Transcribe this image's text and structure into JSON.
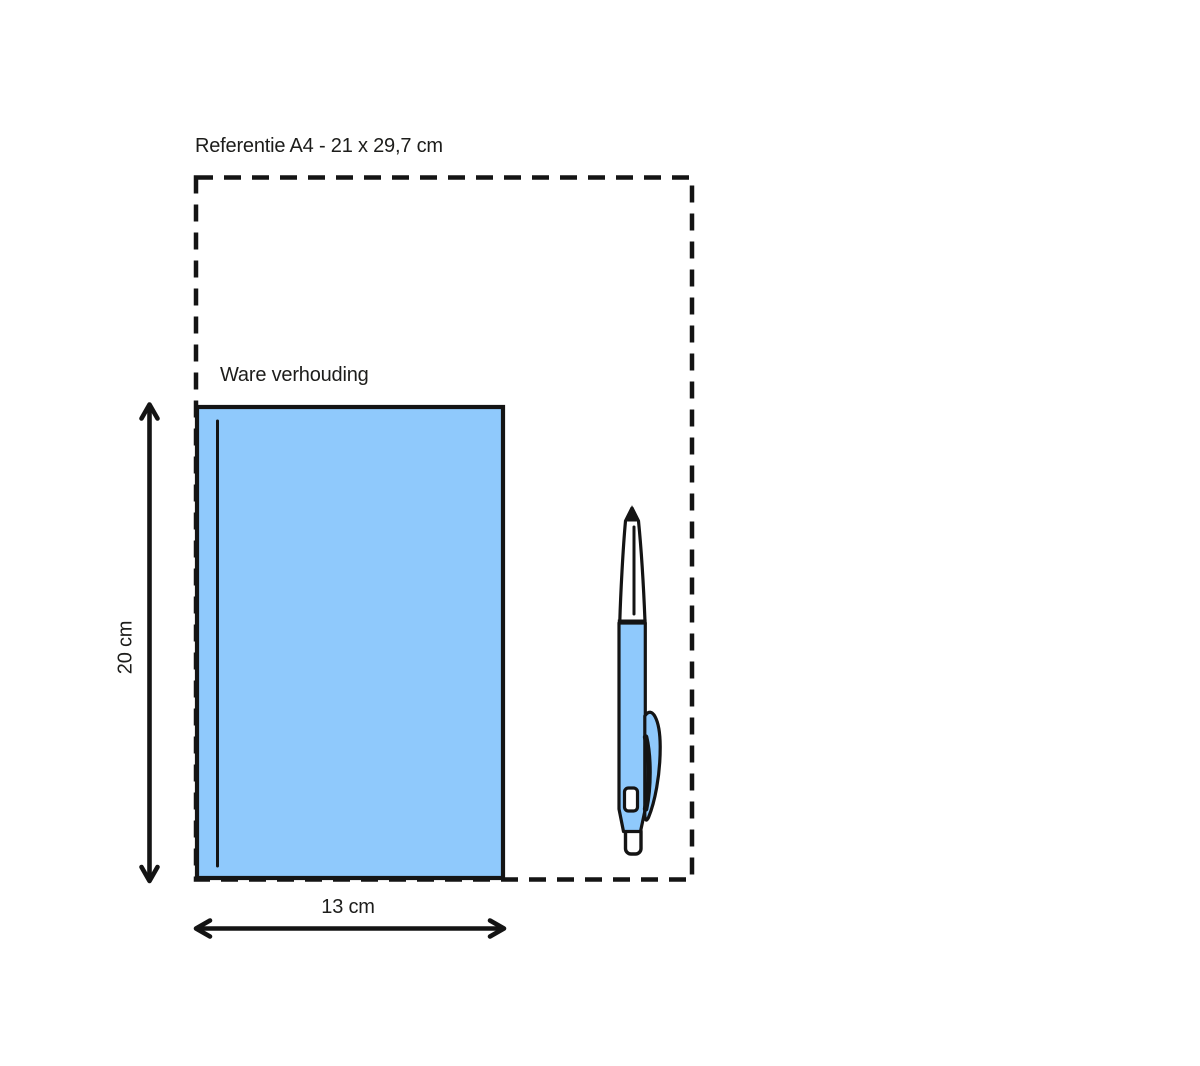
{
  "diagram": {
    "title": "Referentie A4 - 21 x 29,7 cm",
    "object_label": "Ware verhouding",
    "height_dimension": "20 cm",
    "width_dimension": "13 cm"
  },
  "colors": {
    "object_fill": "#8FC9FC",
    "outline": "#141414",
    "text": "#1D1D1B",
    "background": "#FFFFFF"
  }
}
